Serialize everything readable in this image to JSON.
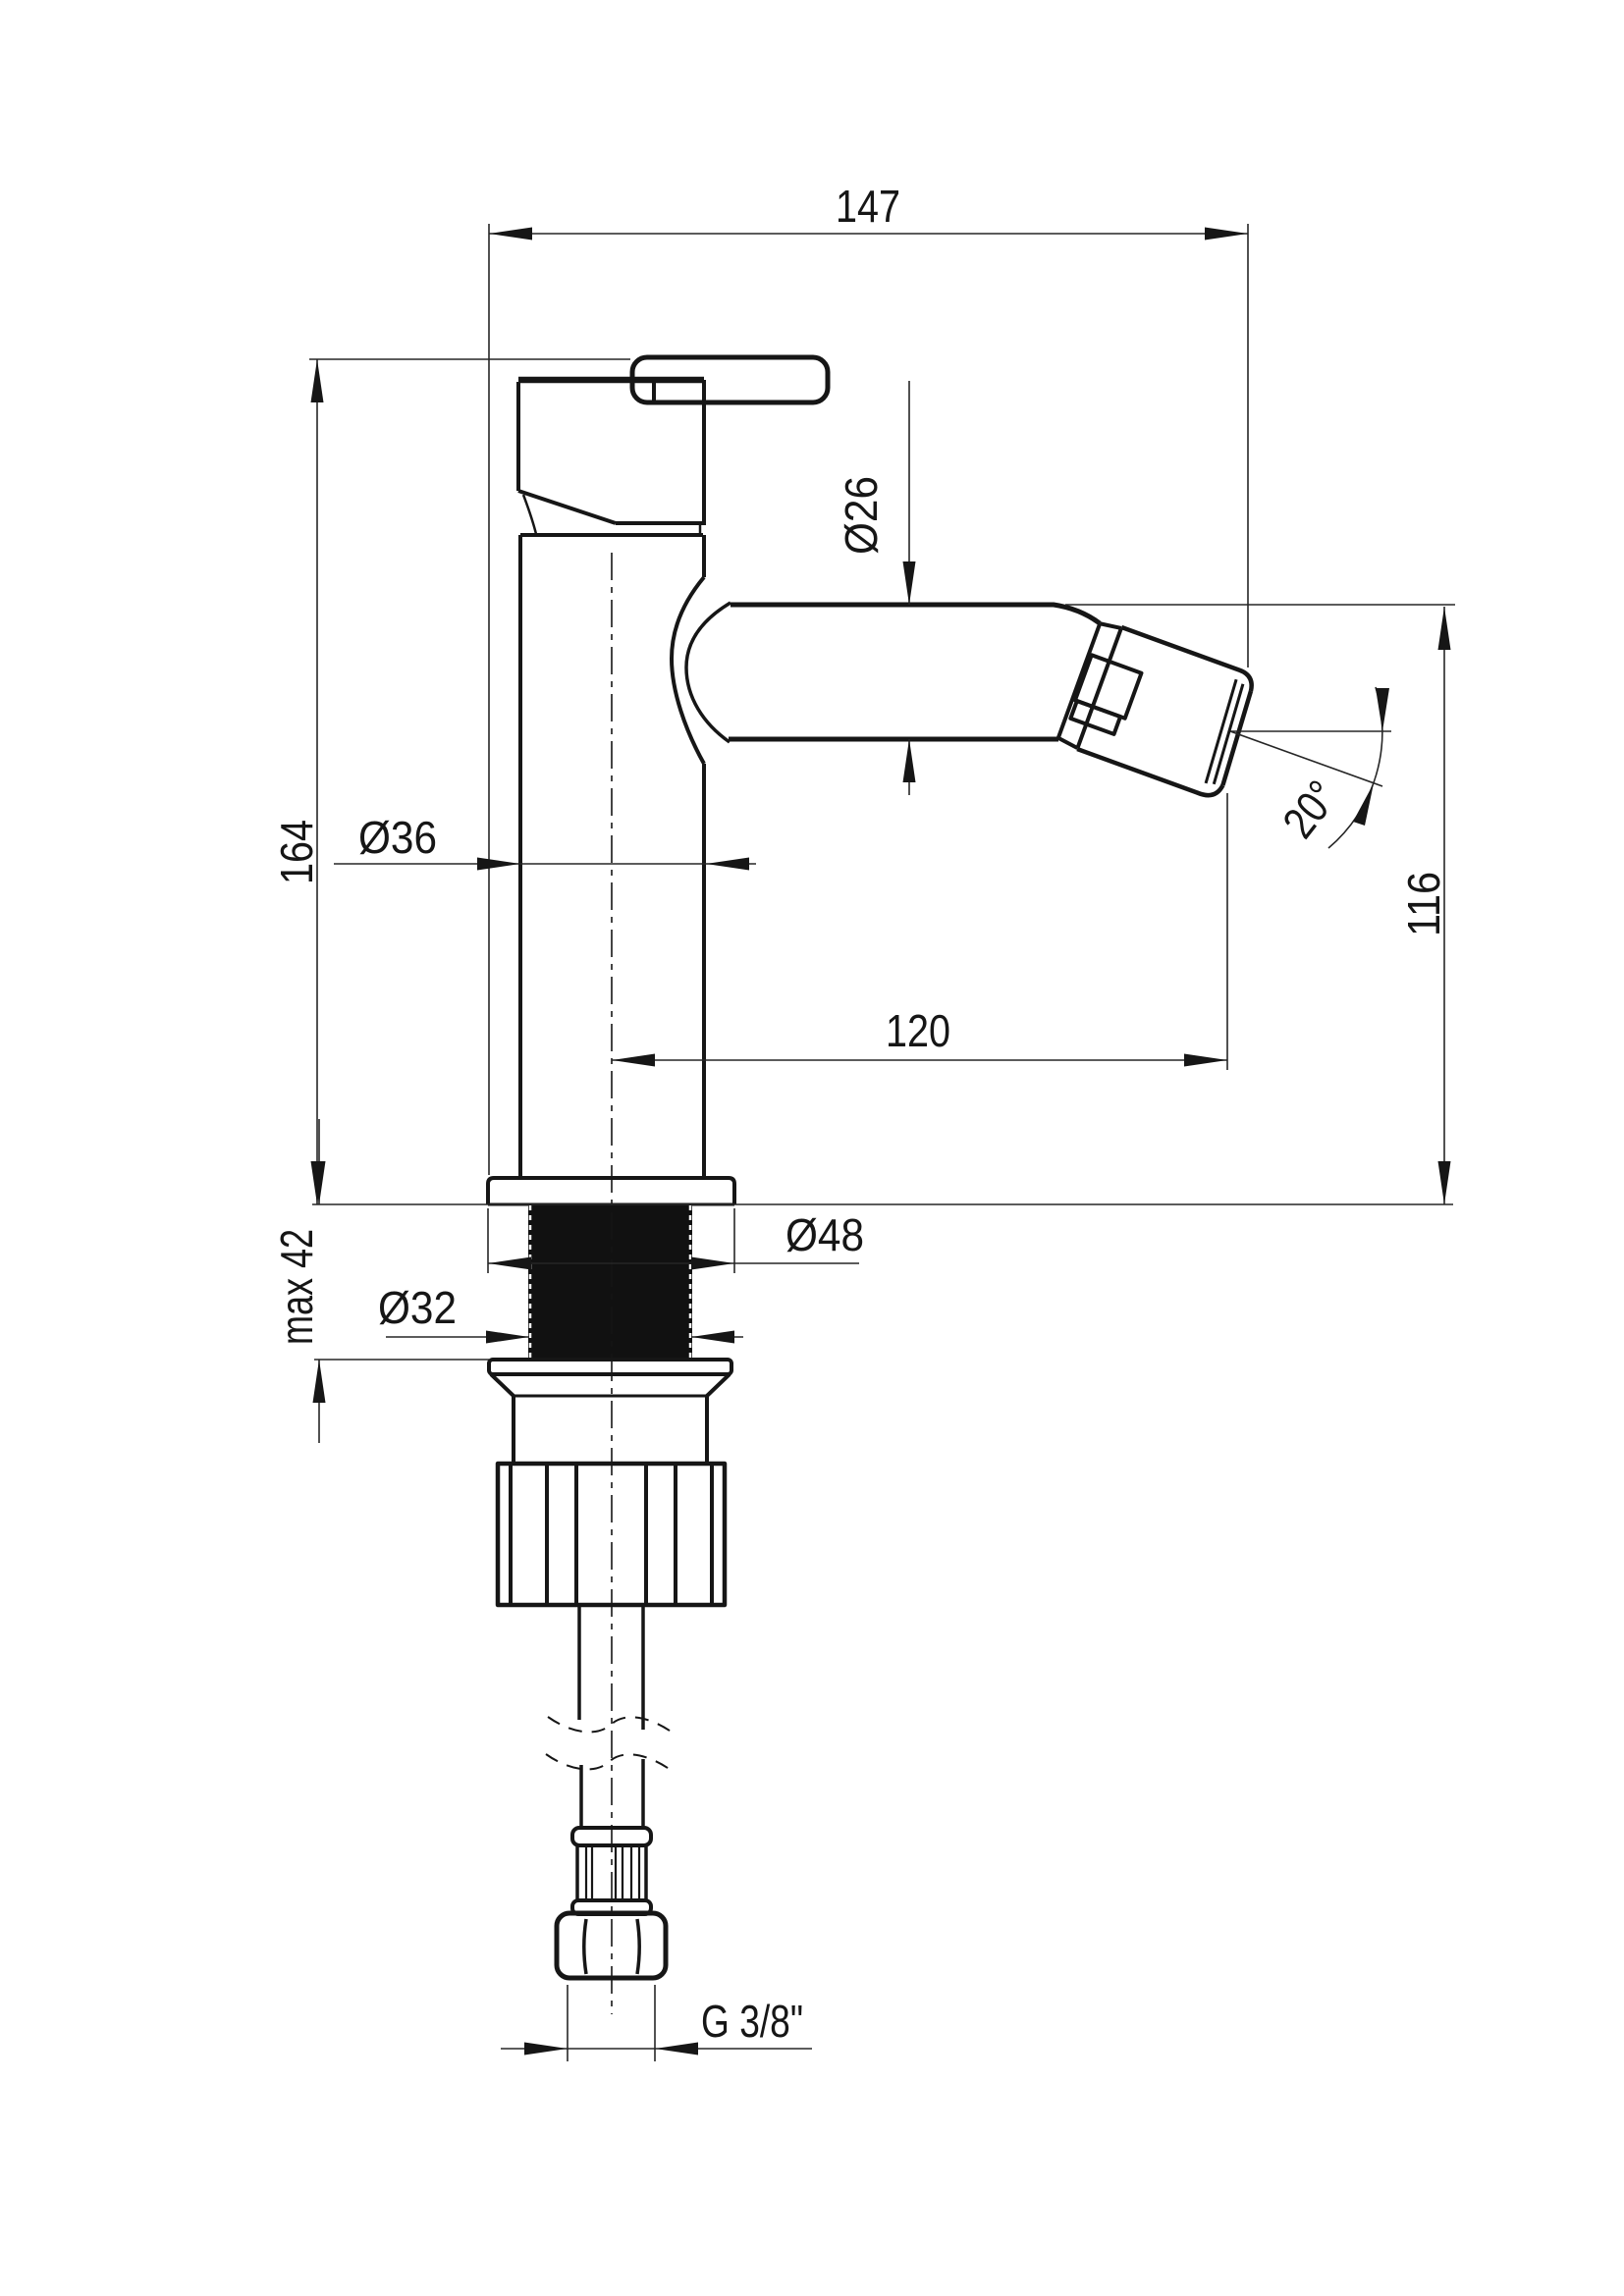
{
  "drawing": {
    "type": "technical-dimension-drawing",
    "subject": "single-lever bidet mixer, side elevation",
    "units": "mm",
    "line_color": "#161616",
    "background_color": "#ffffff",
    "labels": {
      "width_overall": "147",
      "height_overall": "164",
      "spout_outer_diameter": "Ø26",
      "body_diameter": "Ø36",
      "outlet_height": "116",
      "spout_reach": "120",
      "outlet_angle": "20°",
      "deck_max_thickness": "max 42",
      "base_flange_diameter": "Ø48",
      "shank_diameter": "Ø32",
      "supply_connection": "G 3/8\""
    }
  }
}
